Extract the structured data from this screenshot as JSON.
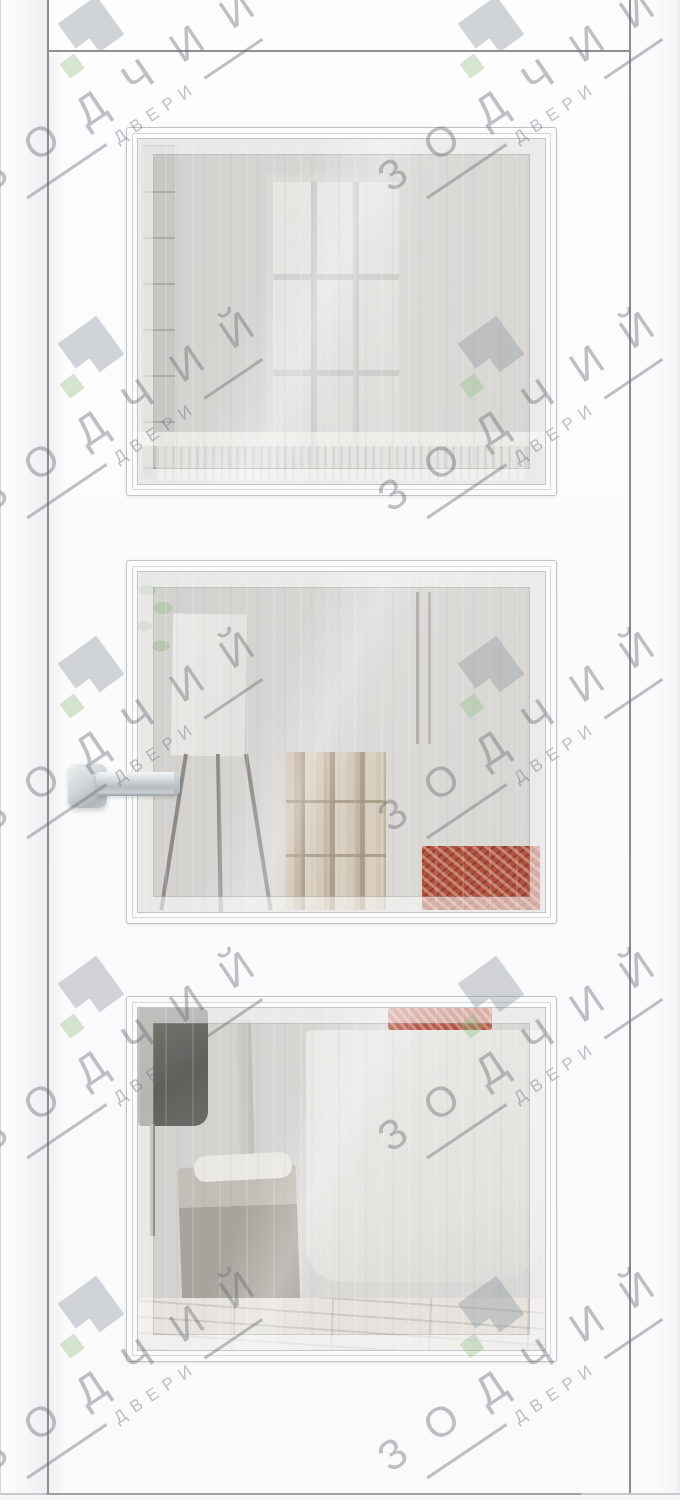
{
  "watermark": {
    "brand": "ЗОДЧИЙ",
    "subtitle": "ДВЕРИ",
    "text_color": "rgba(104,108,116,0.42)",
    "logo_colors": {
      "gray": "rgba(148,154,162,0.42)",
      "green": "rgba(148,190,138,0.38)"
    },
    "units": [
      {
        "x": 87,
        "y": 47
      },
      {
        "x": 487,
        "y": 47
      },
      {
        "x": 87,
        "y": 367
      },
      {
        "x": 487,
        "y": 367
      },
      {
        "x": 87,
        "y": 687
      },
      {
        "x": 487,
        "y": 687
      },
      {
        "x": 87,
        "y": 1007
      },
      {
        "x": 487,
        "y": 1007
      },
      {
        "x": 87,
        "y": 1327
      },
      {
        "x": 487,
        "y": 1327
      }
    ]
  },
  "door": {
    "face_color": "#fcfcfd",
    "edge_line_color": "#8c9093",
    "panel_frame_line_color": "#bfc3c5",
    "glass_color": "#d6d5d2",
    "panel_count": "3",
    "handle": {
      "finish": "chrome",
      "color": "#c9cdd0"
    }
  }
}
